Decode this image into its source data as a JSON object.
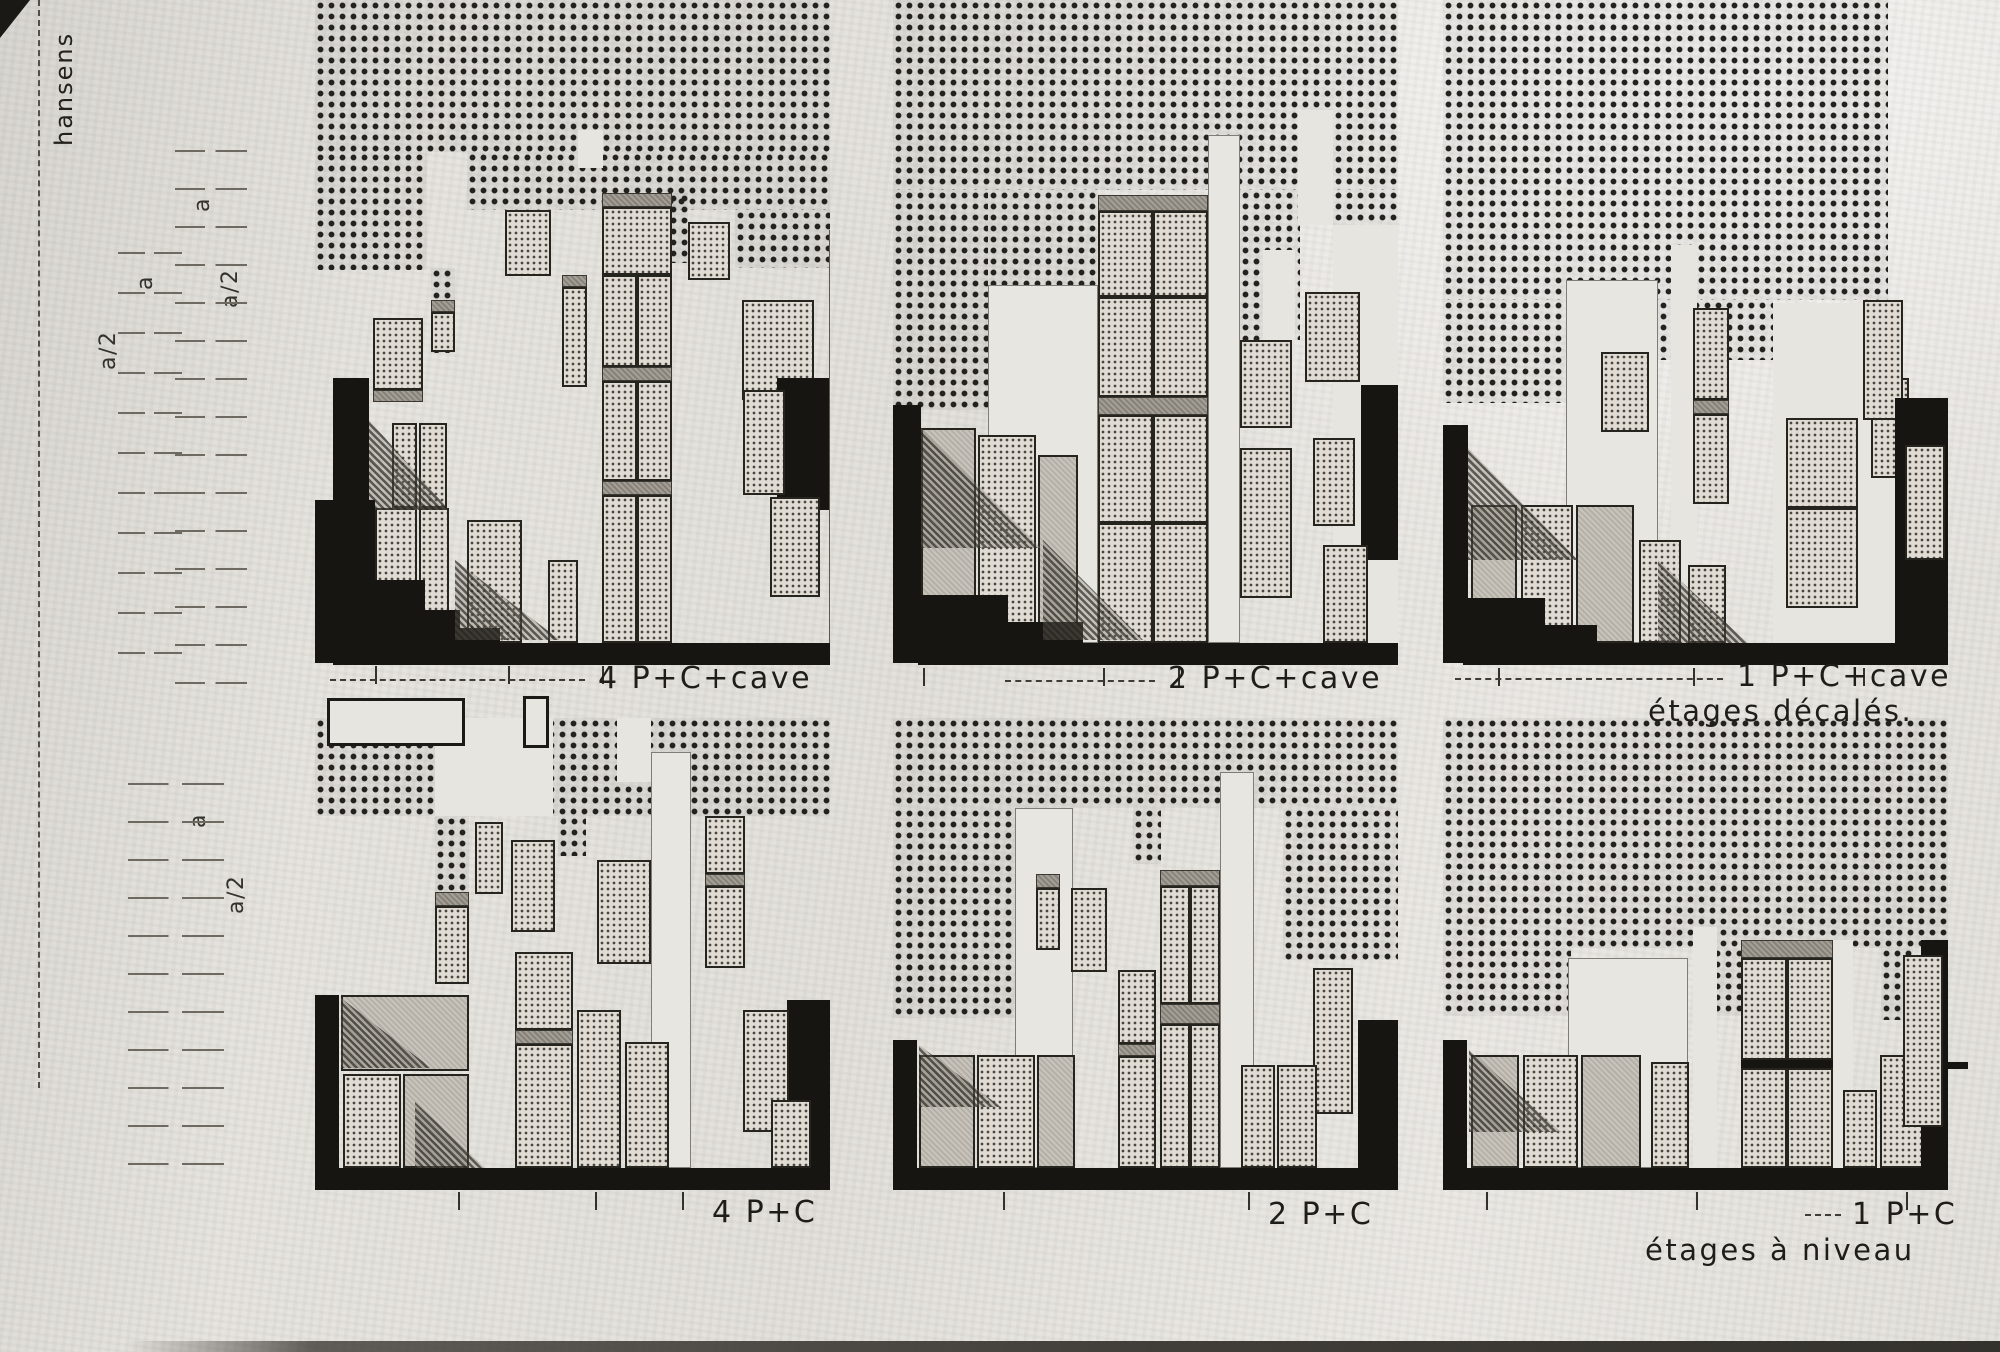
{
  "margin": {
    "signature": "hansens",
    "scale_top": [
      "a",
      "a",
      "a/2",
      "a/2"
    ],
    "scale_bottom": [
      "a",
      "a/2"
    ]
  },
  "panels": [
    {
      "label": "4 P+C+cave"
    },
    {
      "label": "2 P+C+cave"
    },
    {
      "label": "1 P+C+cave",
      "sublabel": "étages décalés."
    },
    {
      "label": "4 P+C"
    },
    {
      "label": "2 P+C"
    },
    {
      "label": "1 P+C",
      "sublabel": "étages à niveau"
    }
  ]
}
